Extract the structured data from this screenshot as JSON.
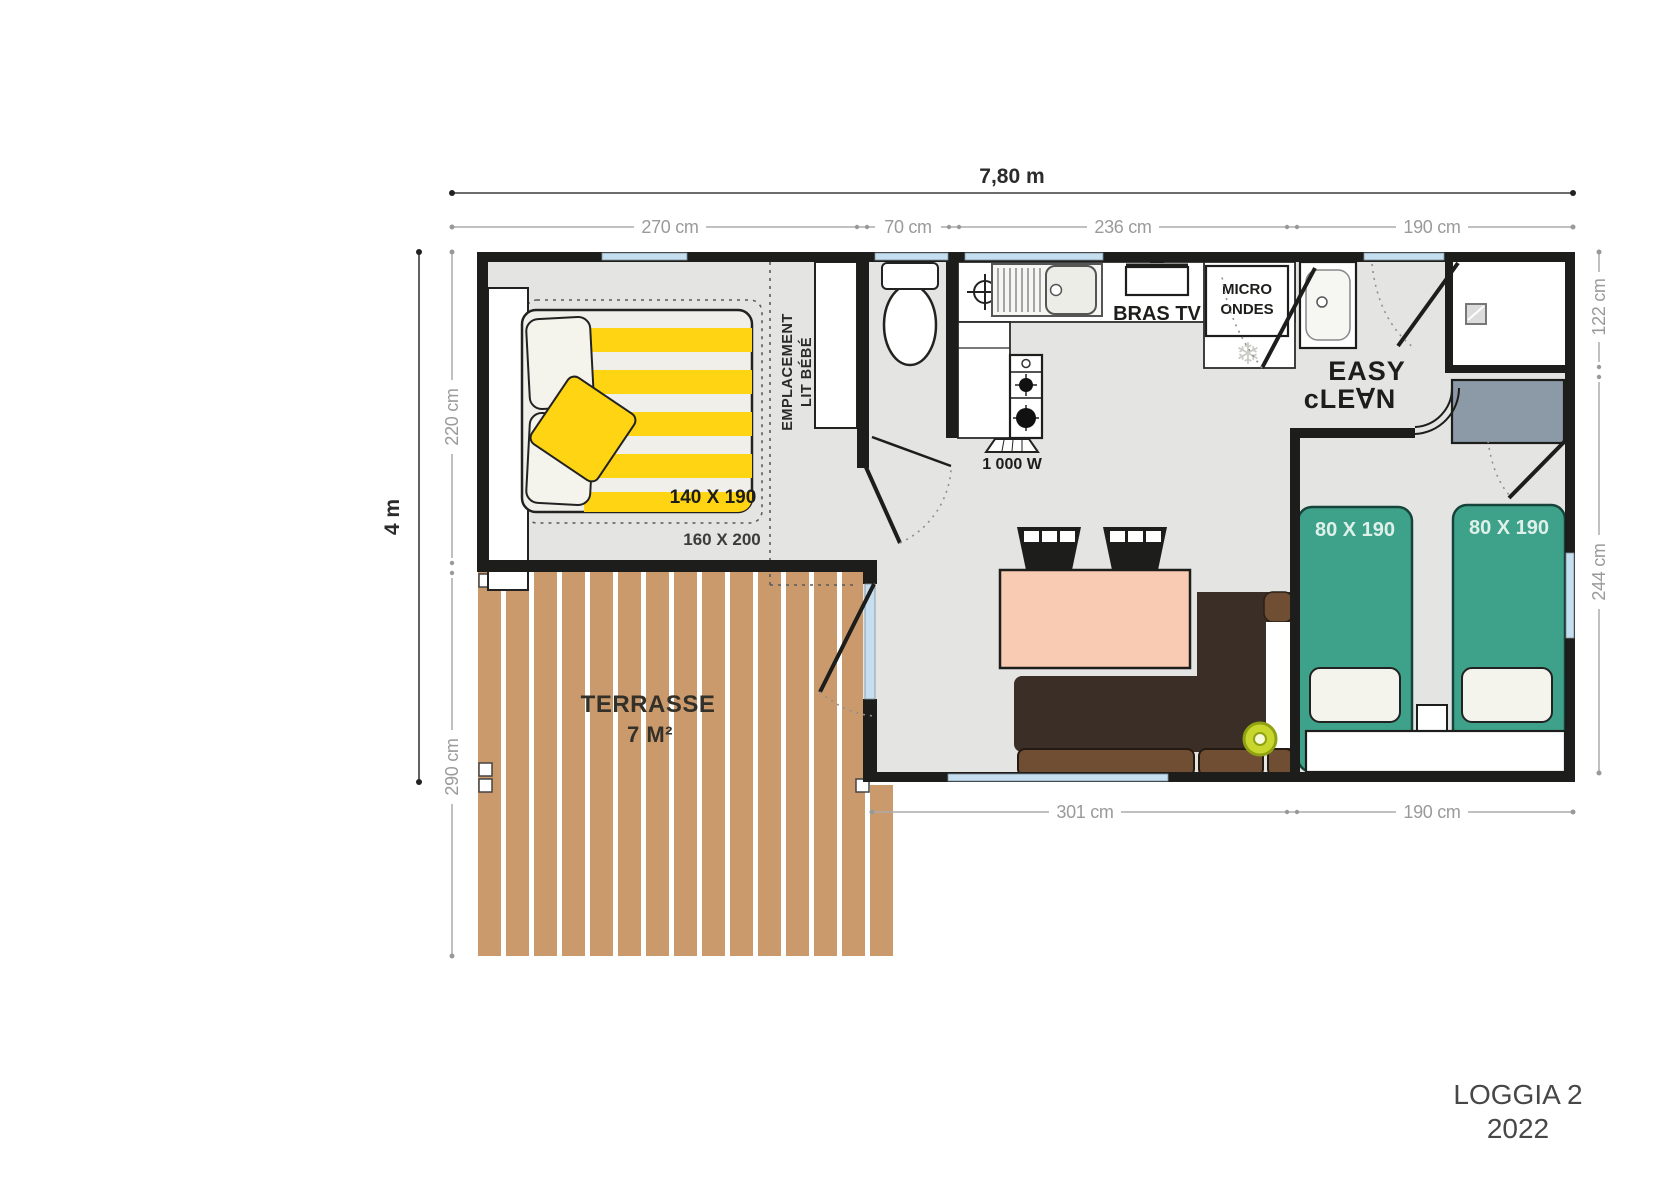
{
  "title": {
    "line1": "LOGGIA 2",
    "line2": "2022"
  },
  "dims": {
    "overall_w": "7,80 m",
    "overall_h": "4 m",
    "top": [
      "270 cm",
      "70 cm",
      "236 cm",
      "190 cm"
    ],
    "left_upper": "220 cm",
    "left_lower": "290 cm",
    "right_upper": "122 cm",
    "right_lower": "244 cm",
    "bottom_left": "301 cm",
    "bottom_right": "190 cm"
  },
  "rooms": {
    "terrace": {
      "name": "TERRASSE",
      "area": "7 M²"
    },
    "bedroom1": {
      "bed_label": "140 X 190",
      "zone_label": "160 X 200",
      "baby_line1": "EMPLACEMENT",
      "baby_line2": "LIT BÉBÉ"
    },
    "bedroom2": {
      "bed1_label": "80 X 190",
      "bed2_label": "80 X 190"
    },
    "kitchen": {
      "tv": "BRAS TV",
      "micro_line1": "MICRO",
      "micro_line2": "ONDES",
      "heater": "1 000 W"
    },
    "bathroom": {
      "brand_line1": "EASY",
      "brand_line2": "cLE∀N"
    }
  },
  "icons": {
    "fridge_snowflake": "❄"
  },
  "colors": {
    "wall": "#1d1d1b",
    "floor": "#E4E4E3",
    "wood": "#CA9A6C",
    "glass": "#C5DFF0",
    "bed_green": "#3EA28B",
    "accent_yellow": "#FFD413",
    "table_salmon": "#F9CBB2",
    "sofa_dark": "#3A2E26",
    "sofa_cushion": "#6F4E33",
    "wardrobe_gray": "#8C99A6",
    "stool_lime": "#C9D62E",
    "dim_text": "#9A9A9A"
  }
}
